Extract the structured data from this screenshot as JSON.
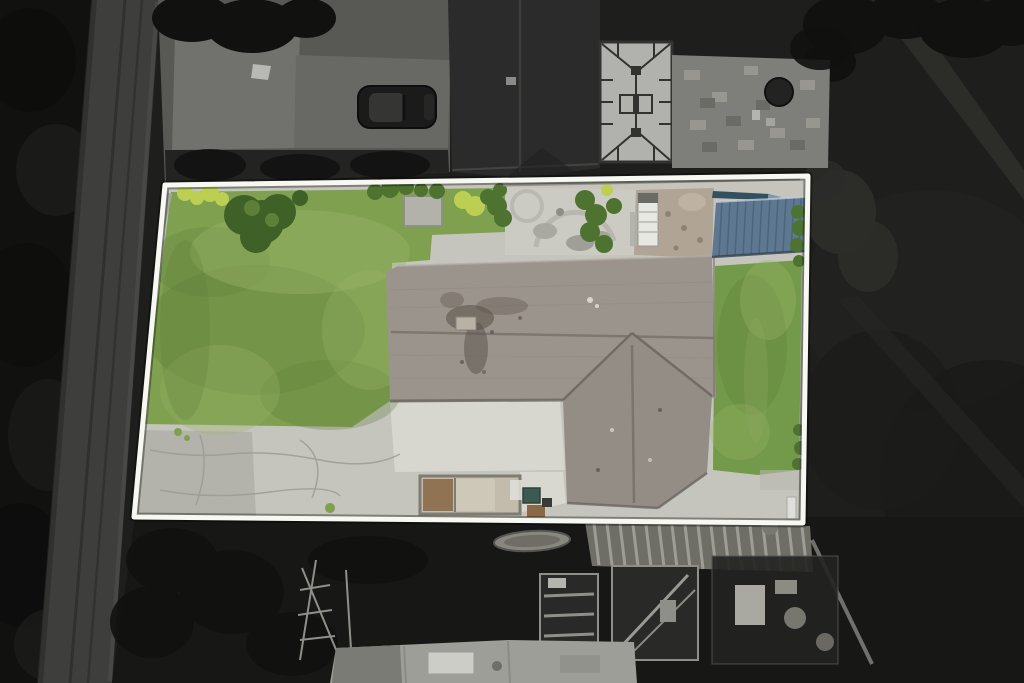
{
  "scene": {
    "kind": "aerial-photo",
    "highlight": "property-plot-outline"
  },
  "colors": {
    "field_dark": "#1e1e1d",
    "trees_dark": "#111110",
    "tree_soft": "#2c2c29",
    "road_grey": "#3e3e3c",
    "road_mark": "#2d2d2b",
    "pavement_mid": "#585854",
    "pavement_light": "#71716d",
    "front_strip_dark": "#232321",
    "car_body": "#1b1b1b",
    "car_roof": "#353533",
    "neighbor_roof": "#2b2b2b",
    "neighbor_ridge": "#3e3e3d",
    "conservatory_panel": "#b1b1ae",
    "conservatory_frame": "#323231",
    "patio_block": "#7e7e7b",
    "patio_block_light": "#97978f",
    "patio_block_dark": "#6a6a67",
    "table_top": "#232322",
    "yard_dark": "#171716",
    "clutter_frame": "#8f8f89",
    "clutter_fill": "#292927",
    "stripe_roof_base": "#6e6e66",
    "stripe_roof_light": "#a3a39b",
    "building_roof": "#9e9e98",
    "building_roof_dark": "#7b7b76",
    "building_box_white": "#cdcdc7",
    "boat_grey": "#87877f",
    "boundary_white": "#f8f8f3",
    "boundary_halo": "rgba(0,0,0,0.35)",
    "plot_concrete": "#c5c5be",
    "concrete_bright": "#d8d8d1",
    "gravel": "#aeaea6",
    "crack_grey": "#9a9a93",
    "lawn_green": "#7fa04f",
    "lawn_green_right": "#739a4a",
    "lawn_shade": "#5d7d39",
    "lawn_light": "#9ab468",
    "bush_green": "#3f6128",
    "shrub_green": "#4e7330",
    "bush_yellow": "#bccf52",
    "pad_grey": "#b2b2aa",
    "wall_stone": "#a3a39b",
    "house_roof": "#9b948d",
    "house_roof_dark": "#948d86",
    "roof_ridge": "#7b746d",
    "roof_valley": "#6f6861",
    "roof_eave": "#6b6560",
    "roof_stain": "#585047",
    "chimney_light": "#b9b2a4",
    "blue_canopy": "#5d7890",
    "blue_canopy_dark": "#42596f",
    "canoe_dark": "#32505e",
    "caravan_white": "#e8e8e3",
    "dirt_patch": "#b0a494",
    "pit_frame": "#7d7d73",
    "pit_soil": "#8f7352",
    "pit_sand": "#cfc8b8",
    "bin_teal": "#3c5a52",
    "box_brown": "#8a6a46",
    "post_white": "#dededa"
  }
}
